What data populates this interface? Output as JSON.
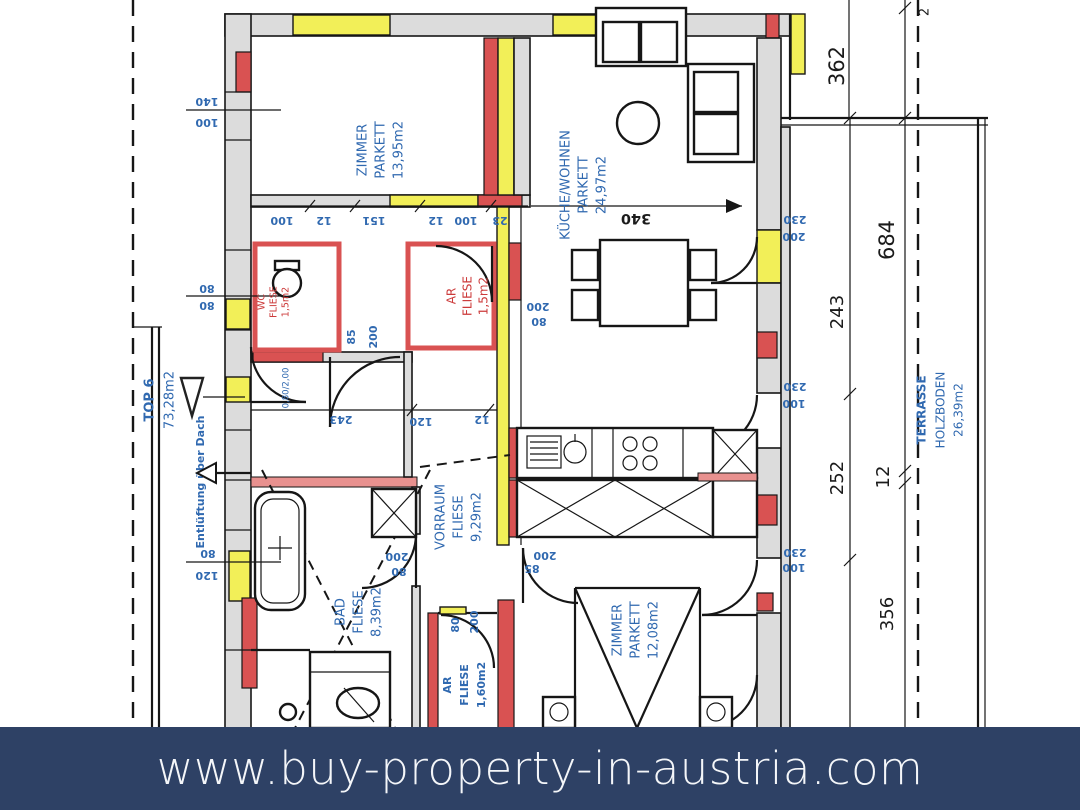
{
  "banner": {
    "url": "www.buy-property-in-austria.com"
  },
  "unit": {
    "name": "TOP 6",
    "area": "73,28m2",
    "vent_note": "Entlüftung über Dach"
  },
  "rooms": {
    "zimmer_top": {
      "name": "ZIMMER",
      "floor": "PARKETT",
      "area": "13,95m2"
    },
    "kueche": {
      "name": "KÜCHE/WOHNEN",
      "floor": "PARKETT",
      "area": "24,97m2"
    },
    "wc": {
      "name": "WC",
      "floor": "FLIESE",
      "area": "1,5m2"
    },
    "ar_top": {
      "name": "AR",
      "floor": "FLIESE",
      "area": "1,5m2"
    },
    "vorraum": {
      "name": "VORRAUM",
      "floor": "FLIESE",
      "area": "9,29m2"
    },
    "bad": {
      "name": "BAD",
      "floor": "FLIESE",
      "area": "8,39m2"
    },
    "ar_bottom": {
      "name": "AR",
      "floor": "FLIESE",
      "area": "1,60m2"
    },
    "zimmer_bottom": {
      "name": "ZIMMER",
      "floor": "PARKETT",
      "area": "12,08m2"
    },
    "terrasse": {
      "name": "TERRASSE",
      "floor": "HOLZBODEN",
      "area": "26,39m2"
    }
  },
  "dims": {
    "right_362": "362",
    "right_684": "684",
    "right_243": "243",
    "right_252": "252",
    "right_12": "12",
    "right_356": "356",
    "top_right_2": "2",
    "kueche_340": "340",
    "chain_top": [
      "100",
      "12",
      "151",
      "12",
      "100",
      "23"
    ],
    "row_mid": [
      "243",
      "120",
      "12"
    ],
    "left_140": "140",
    "left_100": "100",
    "left_80a": "80",
    "left_80b": "80",
    "left_80c": "80",
    "left_120": "120",
    "wc_door": [
      "85",
      "200"
    ],
    "ar_top_door": [
      "200",
      "80"
    ],
    "kueche_door": [
      "200",
      "85"
    ],
    "bad_door": [
      "200",
      "80"
    ],
    "ar_bottom_door": [
      "80",
      "200"
    ],
    "terrace_door": [
      "230",
      "200"
    ],
    "right_door_mid": [
      "230",
      "100"
    ],
    "right_door_low": [
      "230",
      "100"
    ],
    "entrance_size": "0,80/2,00"
  },
  "colors": {
    "wall_red": "#d95252",
    "window_yellow": "#f2ef58",
    "wall_gray": "#dcdcdc",
    "label_blue": "#3069b0",
    "label_red": "#cc3b3b",
    "banner_bg": "#2e4165",
    "banner_text": "#f4f6f9"
  }
}
